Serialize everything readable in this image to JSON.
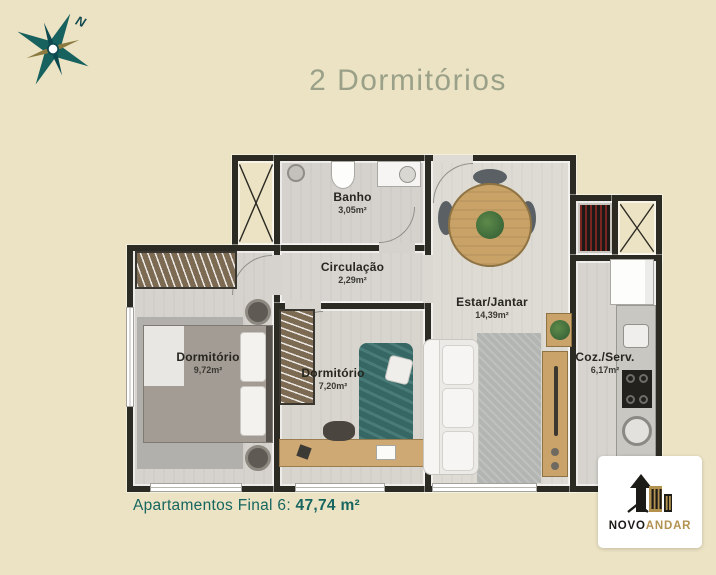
{
  "page": {
    "title": "2 Dormitórios"
  },
  "compass": {
    "letter": "N"
  },
  "plan": {
    "rooms": {
      "banho": {
        "name": "Banho",
        "area": "3,05m²"
      },
      "circulacao": {
        "name": "Circulação",
        "area": "2,29m²"
      },
      "estar": {
        "name": "Estar/Jantar",
        "area": "14,39m²"
      },
      "coz": {
        "name": "Coz./Serv.",
        "area": "6,17m²"
      },
      "dorm1": {
        "name": "Dormitório",
        "area": "9,72m²"
      },
      "dorm2": {
        "name": "Dormitório",
        "area": "7,20m²"
      }
    }
  },
  "footer": {
    "label": "Apartamentos Final 6:",
    "value": "47,74 m²"
  },
  "logo": {
    "brand_primary": "NOVO",
    "brand_secondary": "ANDAR"
  },
  "colors": {
    "background": "#ece3c4",
    "walls": "#2b2a23",
    "title": "#9aa188",
    "accent_teal": "#16655f",
    "logo_gold": "#b3924f"
  }
}
